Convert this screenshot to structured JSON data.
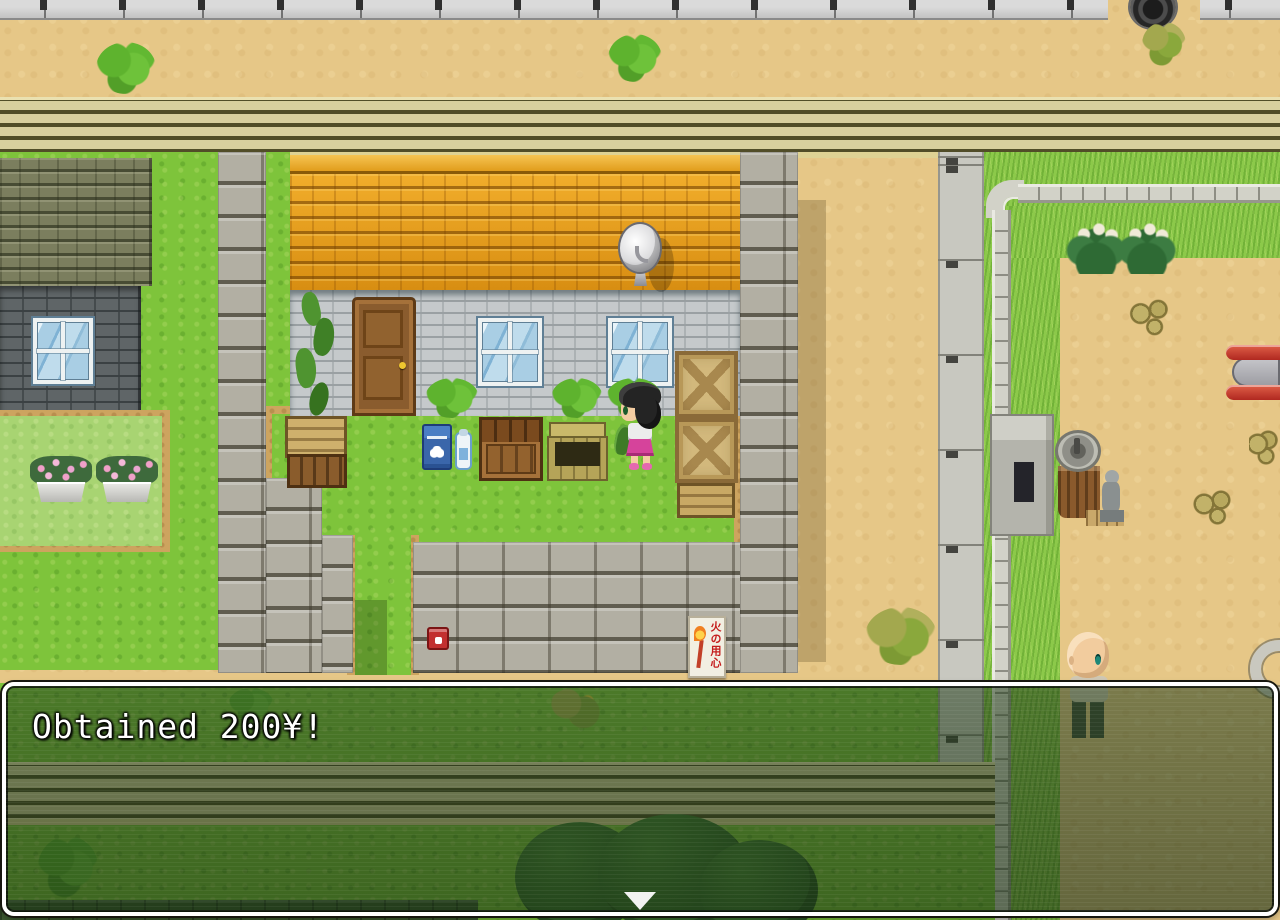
{
  "game": {
    "message_window": {
      "text": "Obtained 200¥!"
    },
    "map": {
      "fire_sign_text": "火の用心",
      "entities": [
        "female-villager",
        "bald-villager",
        "farmhouse",
        "left-house",
        "satellite-dish",
        "stump-water-pump",
        "stone-statue",
        "blue-delivery-box",
        "water-jug",
        "wooden-crates",
        "open-crate",
        "storage-bin",
        "fire-extinguisher-box",
        "fire-caution-sign",
        "flower-planters",
        "playground-slide",
        "manhole-cover",
        "transformer-box",
        "stone-yard-wall",
        "dirt-road",
        "sidewalk",
        "stone-kerb",
        "tree"
      ]
    },
    "colors": {
      "grass": "#7ec43b",
      "sand": "#e6c787",
      "roof_orange": "#e09a1d",
      "road_stripe": "#514d28",
      "window_border": "#ffffff",
      "message_text": "#ffffff",
      "sign_text_red": "#c41c1c"
    }
  }
}
